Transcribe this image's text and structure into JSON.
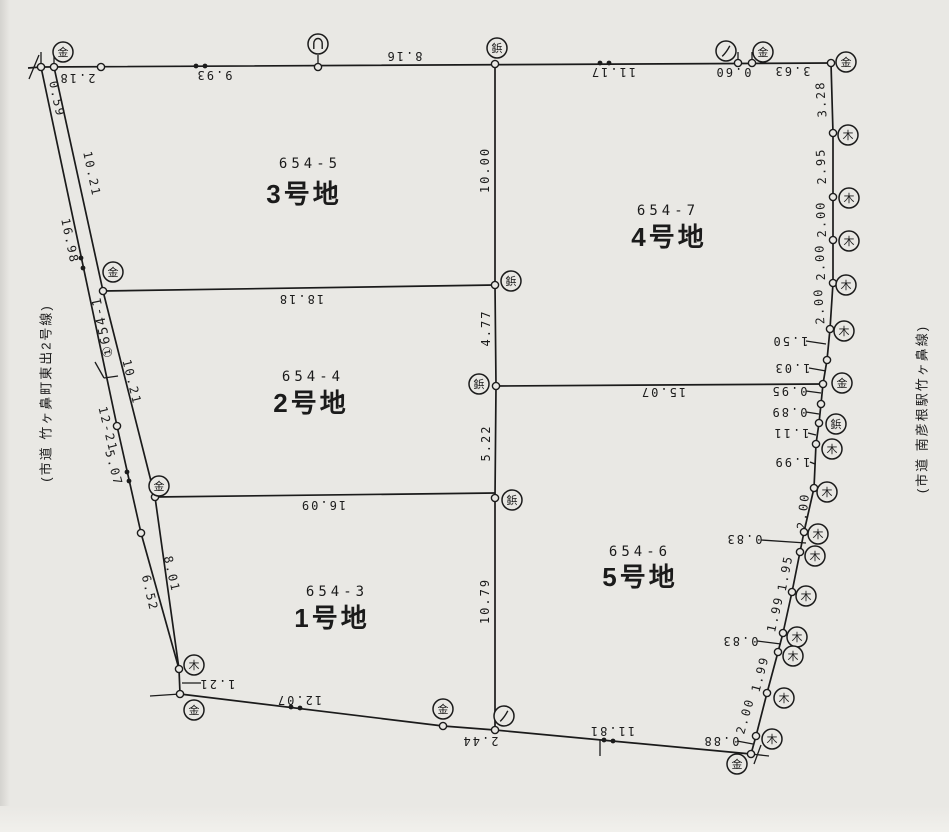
{
  "map": {
    "colors": {
      "paper": "#e9e8e4",
      "ink": "#1b1b1b"
    },
    "road_labels": {
      "left": "(市道 竹ヶ鼻町東出2号線)",
      "right": "(市道 南彦根駅竹ヶ鼻線)"
    },
    "road_parcel_label": "①654-1",
    "parcels": [
      {
        "lot": "654-5",
        "name": "3号地",
        "lot_pos": [
          310,
          168
        ],
        "name_pos": [
          304,
          203
        ]
      },
      {
        "lot": "654-7",
        "name": "4号地",
        "lot_pos": [
          668,
          215
        ],
        "name_pos": [
          669,
          246
        ]
      },
      {
        "lot": "654-4",
        "name": "2号地",
        "lot_pos": [
          313,
          381
        ],
        "name_pos": [
          311,
          412
        ]
      },
      {
        "lot": "654-6",
        "name": "5号地",
        "lot_pos": [
          640,
          556
        ],
        "name_pos": [
          640,
          586
        ]
      },
      {
        "lot": "654-3",
        "name": "1号地",
        "lot_pos": [
          337,
          596
        ],
        "name_pos": [
          332,
          627
        ]
      }
    ],
    "polylines": [
      {
        "name": "top-boundary",
        "pts": "28,68 41,67 831,63"
      },
      {
        "name": "east-boundary",
        "pts": "831,63 833,133 833,197 833,240 833,283 830,329 827,360 823,384 821,404 819,423 816,444 814,488 804,532 800,552 792,592 783,633 778,652 767,693 756,736 751,754"
      },
      {
        "name": "south-boundary",
        "pts": "751,754 495,730 443,726 180,694"
      },
      {
        "name": "west-boundary-road-east-line",
        "pts": "180,694 179,669 155,497 103,291 54,67"
      },
      {
        "name": "road-west-line",
        "pts": "179,669 141,533 117,426 41,67"
      },
      {
        "name": "center-vertical-line",
        "pts": "495,64 495,285 496,386 495,498 495,730"
      },
      {
        "name": "lot-line-18-18",
        "pts": "103,291 495,285"
      },
      {
        "name": "lot-line-16-09",
        "pts": "155,497 495,493"
      },
      {
        "name": "lot-line-15-07",
        "pts": "496,386 823,384"
      }
    ],
    "points": [
      [
        41,
        67
      ],
      [
        54,
        67
      ],
      [
        101,
        67
      ],
      [
        318,
        67
      ],
      [
        495,
        64
      ],
      [
        738,
        63
      ],
      [
        752,
        63
      ],
      [
        831,
        63
      ],
      [
        833,
        133
      ],
      [
        833,
        197
      ],
      [
        833,
        240
      ],
      [
        833,
        283
      ],
      [
        830,
        329
      ],
      [
        827,
        360
      ],
      [
        823,
        384
      ],
      [
        821,
        404
      ],
      [
        819,
        423
      ],
      [
        816,
        444
      ],
      [
        814,
        488
      ],
      [
        804,
        532
      ],
      [
        800,
        552
      ],
      [
        792,
        592
      ],
      [
        783,
        633
      ],
      [
        778,
        652
      ],
      [
        767,
        693
      ],
      [
        756,
        736
      ],
      [
        751,
        754
      ],
      [
        495,
        730
      ],
      [
        443,
        726
      ],
      [
        180,
        694
      ],
      [
        179,
        669
      ],
      [
        141,
        533
      ],
      [
        117,
        426
      ],
      [
        155,
        497
      ],
      [
        103,
        291
      ],
      [
        495,
        285
      ],
      [
        496,
        386
      ],
      [
        495,
        498
      ]
    ],
    "markers": [
      {
        "g": "金",
        "x": 63,
        "y": 52
      },
      {
        "g": "金",
        "x": 763,
        "y": 52
      },
      {
        "g": "金",
        "x": 846,
        "y": 62
      },
      {
        "g": "金",
        "x": 113,
        "y": 272
      },
      {
        "g": "金",
        "x": 159,
        "y": 486
      },
      {
        "g": "金",
        "x": 194,
        "y": 710
      },
      {
        "g": "金",
        "x": 443,
        "y": 709
      },
      {
        "g": "金",
        "x": 737,
        "y": 764
      },
      {
        "g": "金",
        "x": 842,
        "y": 383
      },
      {
        "g": "木",
        "x": 194,
        "y": 665
      },
      {
        "g": "木",
        "x": 848,
        "y": 135
      },
      {
        "g": "木",
        "x": 849,
        "y": 198
      },
      {
        "g": "木",
        "x": 849,
        "y": 241
      },
      {
        "g": "木",
        "x": 846,
        "y": 285
      },
      {
        "g": "木",
        "x": 844,
        "y": 331
      },
      {
        "g": "木",
        "x": 832,
        "y": 449
      },
      {
        "g": "木",
        "x": 827,
        "y": 492
      },
      {
        "g": "木",
        "x": 818,
        "y": 534
      },
      {
        "g": "木",
        "x": 815,
        "y": 556
      },
      {
        "g": "木",
        "x": 806,
        "y": 596
      },
      {
        "g": "木",
        "x": 797,
        "y": 637
      },
      {
        "g": "木",
        "x": 793,
        "y": 656
      },
      {
        "g": "木",
        "x": 784,
        "y": 698
      },
      {
        "g": "木",
        "x": 772,
        "y": 739
      },
      {
        "g": "鋲",
        "x": 497,
        "y": 48
      },
      {
        "g": "鋲",
        "x": 511,
        "y": 281
      },
      {
        "g": "鋲",
        "x": 479,
        "y": 384
      },
      {
        "g": "鋲",
        "x": 512,
        "y": 500
      },
      {
        "g": "鋲",
        "x": 836,
        "y": 424
      },
      {
        "g": "∩",
        "x": 318,
        "y": 44
      },
      {
        "g": "ノ",
        "x": 726,
        "y": 51
      },
      {
        "g": "ノ",
        "x": 504,
        "y": 716
      }
    ],
    "measurements": [
      {
        "t": "2.18",
        "x": 77,
        "y": 78,
        "r": 180
      },
      {
        "t": "9.93",
        "x": 214,
        "y": 75,
        "r": 180
      },
      {
        "t": "8.16",
        "x": 404,
        "y": 56,
        "r": 180
      },
      {
        "t": "11.17",
        "x": 613,
        "y": 72,
        "r": 180
      },
      {
        "t": "0.60",
        "x": 733,
        "y": 72,
        "r": 180
      },
      {
        "t": "3.63",
        "x": 792,
        "y": 71,
        "r": 180
      },
      {
        "t": "3.28",
        "x": 821,
        "y": 99,
        "r": -94
      },
      {
        "t": "2.95",
        "x": 821,
        "y": 166,
        "r": -93
      },
      {
        "t": "2.00",
        "x": 821,
        "y": 219,
        "r": -93
      },
      {
        "t": "2.00",
        "x": 820,
        "y": 262,
        "r": -93
      },
      {
        "t": "2.00",
        "x": 819,
        "y": 306,
        "r": -94
      },
      {
        "t": "1.50",
        "x": 790,
        "y": 341,
        "r": 180
      },
      {
        "t": "1.03",
        "x": 792,
        "y": 368,
        "r": 180
      },
      {
        "t": "0.95",
        "x": 789,
        "y": 391,
        "r": 180
      },
      {
        "t": "0.89",
        "x": 789,
        "y": 412,
        "r": 180
      },
      {
        "t": "1.11",
        "x": 791,
        "y": 433,
        "r": 180
      },
      {
        "t": "1.99",
        "x": 792,
        "y": 462,
        "r": 180
      },
      {
        "t": "2.00",
        "x": 803,
        "y": 511,
        "r": -84
      },
      {
        "t": "0.83",
        "x": 744,
        "y": 539,
        "r": 180
      },
      {
        "t": "1.95",
        "x": 785,
        "y": 573,
        "r": -79
      },
      {
        "t": "1.99",
        "x": 775,
        "y": 614,
        "r": -77
      },
      {
        "t": "0.83",
        "x": 740,
        "y": 641,
        "r": 180
      },
      {
        "t": "1.99",
        "x": 760,
        "y": 674,
        "r": -75
      },
      {
        "t": "2.00",
        "x": 745,
        "y": 716,
        "r": -74
      },
      {
        "t": "0.88",
        "x": 721,
        "y": 741,
        "r": 180
      },
      {
        "t": "11.81",
        "x": 612,
        "y": 731,
        "r": 180
      },
      {
        "t": "2.44",
        "x": 480,
        "y": 741,
        "r": 180
      },
      {
        "t": "12.07",
        "x": 299,
        "y": 700,
        "r": 180
      },
      {
        "t": "1.21",
        "x": 217,
        "y": 684,
        "r": 180
      },
      {
        "t": "0.59",
        "x": 57,
        "y": 99,
        "r": 78
      },
      {
        "t": "10.21",
        "x": 92,
        "y": 174,
        "r": 78
      },
      {
        "t": "16.98",
        "x": 70,
        "y": 241,
        "r": 78
      },
      {
        "t": "10.21",
        "x": 132,
        "y": 382,
        "r": 76
      },
      {
        "t": "12-21",
        "x": 108,
        "y": 429,
        "r": 76
      },
      {
        "t": "5.07",
        "x": 114,
        "y": 468,
        "r": 75
      },
      {
        "t": "8.01",
        "x": 172,
        "y": 574,
        "r": 77
      },
      {
        "t": "6.52",
        "x": 150,
        "y": 593,
        "r": 77
      },
      {
        "t": "18.18",
        "x": 301,
        "y": 299,
        "r": 180
      },
      {
        "t": "16.09",
        "x": 323,
        "y": 505,
        "r": 180
      },
      {
        "t": "15.07",
        "x": 663,
        "y": 392,
        "r": 180
      },
      {
        "t": "10.00",
        "x": 485,
        "y": 170,
        "r": -90
      },
      {
        "t": "4.77",
        "x": 486,
        "y": 328,
        "r": -90
      },
      {
        "t": "5.22",
        "x": 486,
        "y": 443,
        "r": -90
      },
      {
        "t": "10.79",
        "x": 485,
        "y": 601,
        "r": -90
      }
    ],
    "double_dots": [
      [
        196,
        66
      ],
      [
        205,
        66
      ],
      [
        600,
        63
      ],
      [
        609,
        63
      ],
      [
        81,
        258
      ],
      [
        83,
        268
      ],
      [
        127,
        472
      ],
      [
        129,
        481
      ],
      [
        291,
        707
      ],
      [
        300,
        708
      ],
      [
        604,
        740
      ],
      [
        613,
        741
      ]
    ],
    "ticks": [
      [
        41,
        52,
        41,
        66
      ],
      [
        54,
        52,
        54,
        66
      ],
      [
        738,
        52,
        738,
        62
      ],
      [
        752,
        52,
        752,
        62
      ],
      [
        39,
        55,
        29,
        79
      ],
      [
        318,
        55,
        318,
        64
      ],
      [
        751,
        754,
        769,
        756
      ],
      [
        761,
        745,
        754,
        764
      ],
      [
        600,
        740,
        600,
        756
      ],
      [
        150,
        696,
        180,
        694
      ],
      [
        806,
        341,
        826,
        344
      ],
      [
        809,
        368,
        826,
        371
      ],
      [
        806,
        391,
        821,
        393
      ],
      [
        806,
        412,
        819,
        414
      ],
      [
        808,
        433,
        816,
        435
      ],
      [
        810,
        462,
        815,
        464
      ],
      [
        761,
        540,
        806,
        543
      ],
      [
        757,
        641,
        781,
        644
      ],
      [
        737,
        741,
        753,
        744
      ],
      [
        201,
        683,
        182,
        683
      ],
      [
        95,
        362,
        104,
        378
      ],
      [
        104,
        378,
        118,
        376
      ]
    ],
    "label_positions": {
      "road_left": {
        "x": 46,
        "y": 393,
        "r": -90
      },
      "road_right": {
        "x": 922,
        "y": 409,
        "r": -90
      },
      "road_parcel": {
        "x": 102,
        "y": 327,
        "r": -102
      }
    }
  }
}
